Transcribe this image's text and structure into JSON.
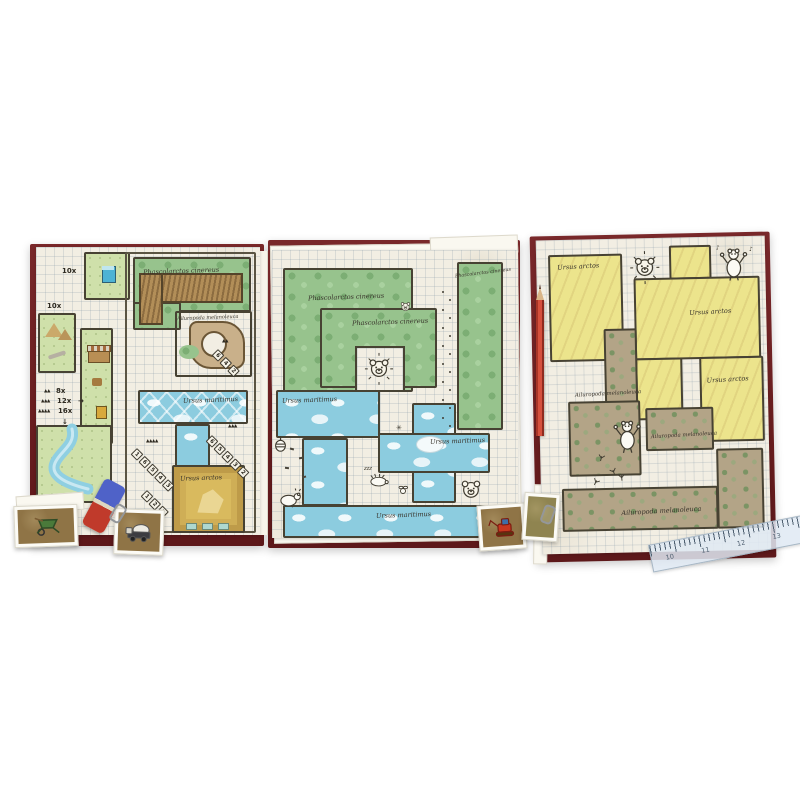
{
  "photo_background": "#ffffff",
  "species": {
    "koala": "Phascolarctos cinereus",
    "panda": "Ailuropoda melanoleuca",
    "polar_bear": "Ursus maritimus",
    "brown_bear": "Ursus arctos"
  },
  "left_board": {
    "toilet_count": "10x",
    "tent_count": "10x",
    "legend": {
      "row1_triangles": "▲▲",
      "row1_count": "8x",
      "row2_triangles": "▲▲▲",
      "row2_count": "12x",
      "row2_arrow": "→",
      "row3_triangles": "▲▲▲▲",
      "row3_count": "16x",
      "down_arrow": "↓"
    },
    "dice_chain_a": {
      "triangles": "▲▲",
      "values": [
        "6",
        "4",
        "2"
      ]
    },
    "dice_chain_b": {
      "triangles": "▲▲▲",
      "values": [
        "6",
        "5",
        "4",
        "3",
        "2"
      ]
    },
    "dice_chain_c": {
      "triangles": "▲▲▲▲",
      "values": [
        "1",
        "6",
        "5",
        "4",
        "3"
      ]
    },
    "dice_chain_d": {
      "values": [
        "1",
        "2",
        "3"
      ]
    }
  },
  "middle_board": {
    "sleep_text": "zzz",
    "asterisk_mark": "✳"
  },
  "right_board": {
    "music_note_left": "♪",
    "music_note_right": "♪"
  },
  "ruler_numbers": [
    "10",
    "11",
    "12",
    "13"
  ]
}
